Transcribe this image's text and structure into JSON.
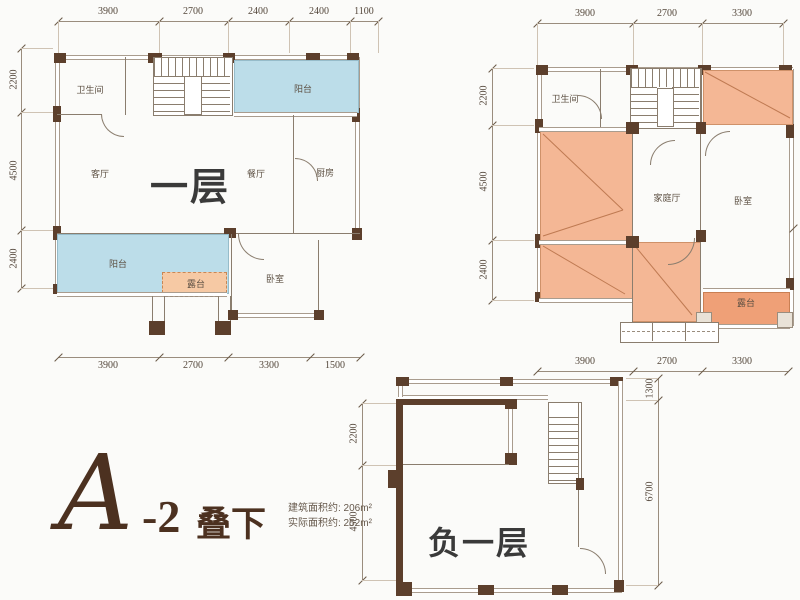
{
  "title_block": {
    "series_letter": "A",
    "series_suffix": "-2",
    "series_type": "叠下",
    "area_line_1": "建筑面积约: 206m²",
    "area_line_2": "实际面积约: 252m²"
  },
  "first_floor": {
    "floor_label": "一层",
    "dims_top": [
      "3900",
      "2700",
      "2400",
      "2400",
      "1100"
    ],
    "dims_bottom": [
      "3900",
      "2700",
      "3300",
      "1500"
    ],
    "dims_left": [
      "2200",
      "4500",
      "2400"
    ],
    "rooms": {
      "bathroom": "卫生间",
      "balcony_top": "阳台",
      "living_room": "客厅",
      "dining_room": "餐厅",
      "kitchen": "厨房",
      "balcony_bottom": "阳台",
      "terrace": "露台",
      "bedroom": "卧室"
    }
  },
  "second_floor": {
    "dims_top": [
      "3900",
      "2700",
      "3300"
    ],
    "dims_bottom": [
      "3900",
      "2700",
      "3300"
    ],
    "dims_left": [
      "2200",
      "4500",
      "2400"
    ],
    "rooms": {
      "bathroom": "卫生间",
      "family_room": "家庭厅",
      "bedroom": "卧室",
      "terrace": "露台"
    }
  },
  "basement": {
    "floor_label": "负一层",
    "dims_left": [
      "2200",
      "4500"
    ],
    "dims_right": [
      "1300",
      "6700"
    ]
  },
  "colors": {
    "wall_brown": "#5c3f2c",
    "balcony_blue": "#bcdde9",
    "roof_orange": "#f4b795",
    "terrace_orange": "#efa077"
  }
}
